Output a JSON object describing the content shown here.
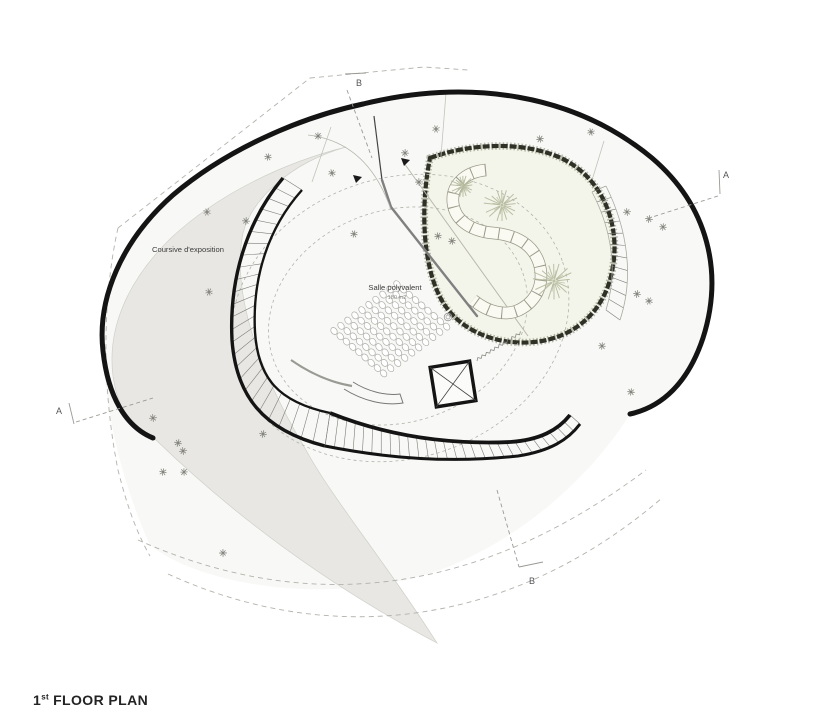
{
  "title": {
    "number": "1",
    "ordinal": "st",
    "rest": "FLOOR PLAN"
  },
  "labels": {
    "coursive": "Coursive d'exposition",
    "salle": "Salle polyvalent",
    "salle_area": "180 m2"
  },
  "sections": {
    "a": "A",
    "b": "B"
  },
  "colors": {
    "paper": "#ffffff",
    "interior": "#f8f8f6",
    "gallery_band": "#e8e7e3",
    "courtyard_fill": "#f4f5ea",
    "courtyard_edge": "#2f3127",
    "courtyard_edge_soft": "#787b62",
    "wall": "#141414",
    "line": "#8d8d88",
    "faint_line": "#c3c3bc",
    "dashed": "#b2b2ac",
    "tree": "#b4b99c",
    "chair_stroke": "#aeaea8",
    "text": "#3c3c3c",
    "text_light": "#8a8a86"
  },
  "seating": {
    "start_x": 334,
    "start_y": 331,
    "along_dx": 7.0,
    "along_dy": -5.2,
    "row_dx": 6.2,
    "row_dy": 5.3,
    "row_counts": [
      10,
      10,
      10,
      10,
      10,
      10,
      10,
      10,
      10
    ],
    "chair_rx": 2.9,
    "chair_ry": 3.8,
    "chair_angle": -37
  },
  "trees": [
    {
      "x": 463,
      "y": 186,
      "r": 13
    },
    {
      "x": 502,
      "y": 205,
      "r": 19
    },
    {
      "x": 554,
      "y": 281,
      "r": 22
    }
  ],
  "stair_ticks": [
    26,
    28,
    11
  ],
  "vegetation": [
    [
      207,
      212
    ],
    [
      246,
      221
    ],
    [
      268,
      157
    ],
    [
      318,
      136
    ],
    [
      332,
      173
    ],
    [
      354,
      234
    ],
    [
      405,
      153
    ],
    [
      419,
      182
    ],
    [
      436,
      129
    ],
    [
      438,
      236
    ],
    [
      452,
      241
    ],
    [
      540,
      139
    ],
    [
      591,
      132
    ],
    [
      627,
      212
    ],
    [
      649,
      219
    ],
    [
      663,
      227
    ],
    [
      637,
      294
    ],
    [
      649,
      301
    ],
    [
      602,
      346
    ],
    [
      631,
      392
    ],
    [
      209,
      292
    ],
    [
      153,
      418
    ],
    [
      178,
      443
    ],
    [
      183,
      451
    ],
    [
      163,
      472
    ],
    [
      184,
      472
    ],
    [
      223,
      553
    ],
    [
      263,
      434
    ]
  ]
}
